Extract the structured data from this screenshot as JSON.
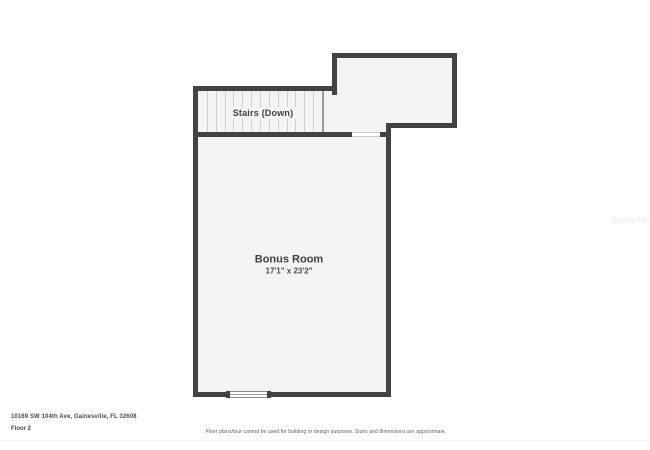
{
  "floor_plan": {
    "stairs_label": "Stairs (Down)",
    "room": {
      "name": "Bonus Room",
      "dimensions": "17'1\" x 23'2\""
    }
  },
  "footer": {
    "address": "10169 SW 104th Ave, Gainesville, FL 32608",
    "floor_label": "Floor 2",
    "disclaimer": "Floor plans/tour cannot be used for building or design purposes. Sizes and dimensions are approximate."
  },
  "watermark": "StellarMLS",
  "colors": {
    "wall": "#434343",
    "room_fill": "#f4f4f5",
    "tread_line": "#cfcfcf",
    "label_text": "#3e3e3e",
    "watermark_text": "#ededed",
    "background": "#ffffff"
  }
}
